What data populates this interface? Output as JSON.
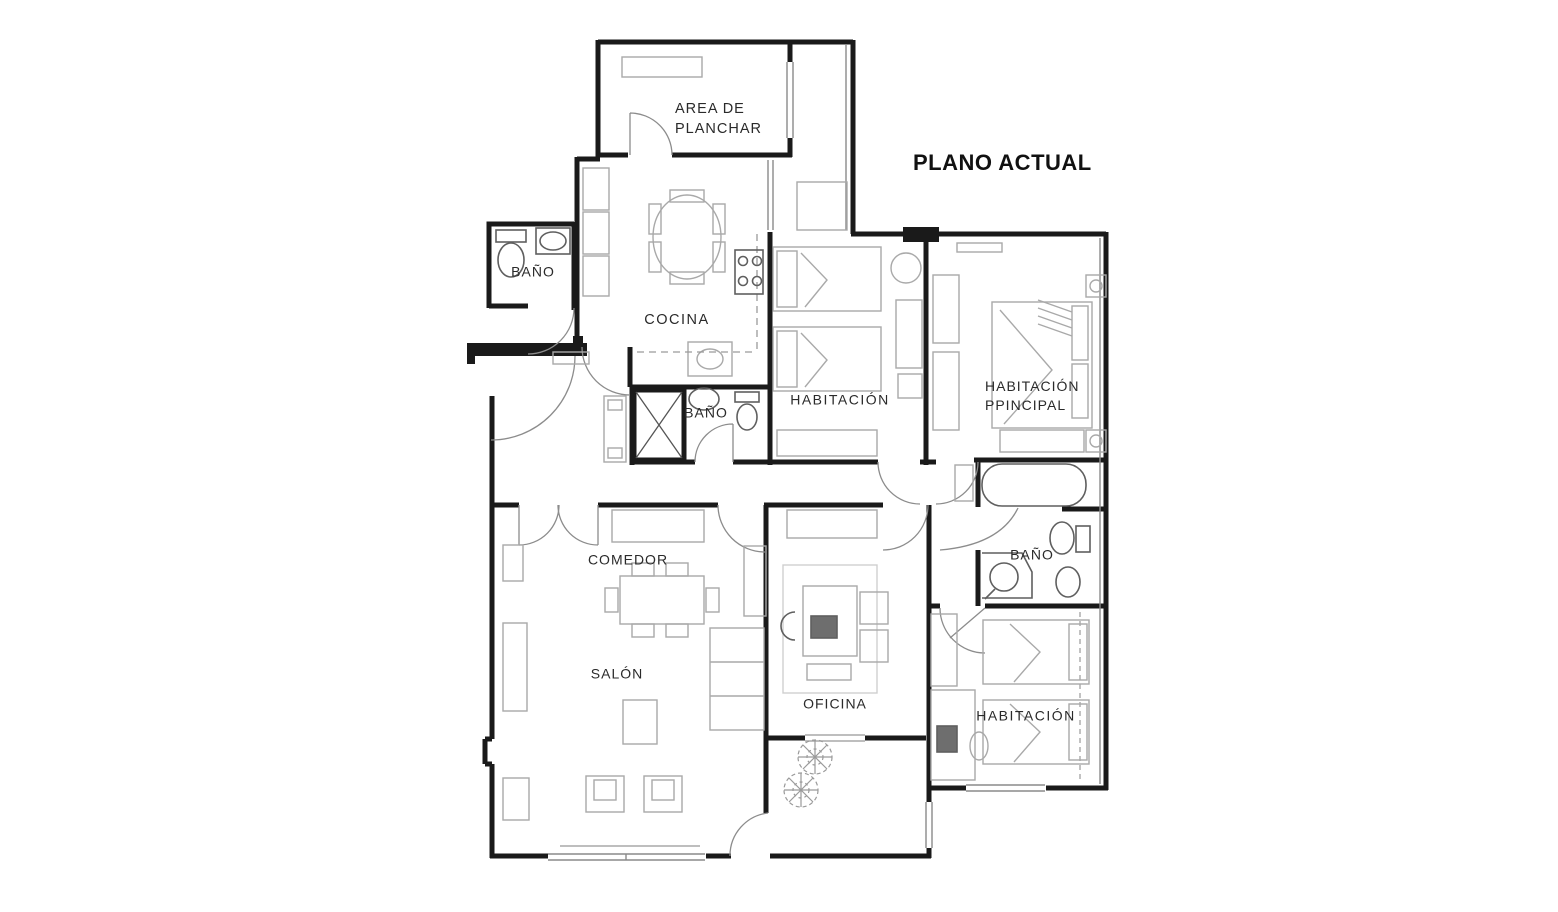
{
  "title": "PLANO ACTUAL",
  "rooms": [
    {
      "name": "area-de-planchar",
      "label": "AREA DE\nPLANCHAR"
    },
    {
      "name": "bano-top-left",
      "label": "BAÑO"
    },
    {
      "name": "cocina",
      "label": "COCINA"
    },
    {
      "name": "bano-middle",
      "label": "BAÑO"
    },
    {
      "name": "habitacion-top",
      "label": "HABITACIÓN"
    },
    {
      "name": "habitacion-principal",
      "label": "HABITACIÓN\nPPINCIPAL"
    },
    {
      "name": "comedor",
      "label": "COMEDOR"
    },
    {
      "name": "salon",
      "label": "SALÓN"
    },
    {
      "name": "oficina",
      "label": "OFICINA"
    },
    {
      "name": "bano-right",
      "label": "BAÑO"
    },
    {
      "name": "habitacion-bottom",
      "label": "HABITACIÓN"
    }
  ],
  "colors": {
    "wall": "#1a1a1a",
    "window": "#8a8a8a",
    "door": "#8c8c8c",
    "furniture": "#a9a9a9",
    "fixture": "#5f5f5f",
    "background": "#ffffff"
  }
}
